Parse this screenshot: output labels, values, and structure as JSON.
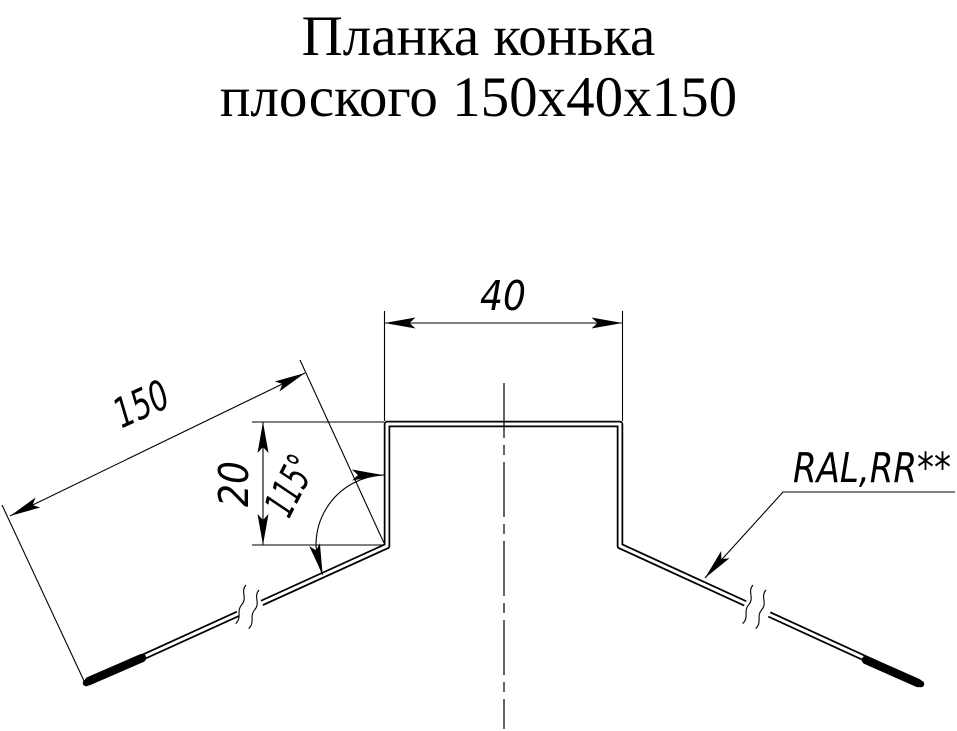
{
  "title": {
    "line1": "Планка конька",
    "line2": "плоского 150х40х150"
  },
  "dimensions": {
    "top_width": "40",
    "slope_length": "150",
    "step_height": "20",
    "bend_angle": "115°"
  },
  "annotations": {
    "coating": "RAL,RR**"
  },
  "colors": {
    "line": "#000000",
    "background": "#ffffff"
  }
}
